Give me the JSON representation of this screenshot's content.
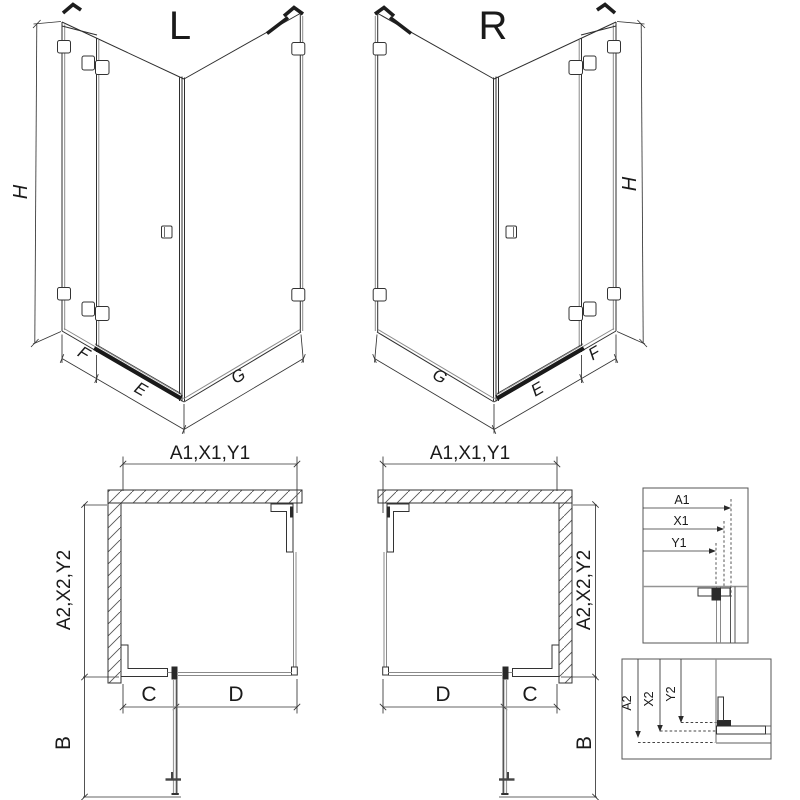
{
  "drawing": {
    "type": "shower-enclosure-technical-drawing",
    "background": "#ffffff",
    "line_color": "#2e2e2e",
    "glass_line_color": "#8a8a8a"
  },
  "variant_left": {
    "label": "L",
    "dim_height": "H",
    "dim_fixed": "F",
    "dim_door": "E",
    "dim_side": "G"
  },
  "variant_right": {
    "label": "R",
    "dim_height": "H",
    "dim_fixed": "F",
    "dim_door": "E",
    "dim_side": "G"
  },
  "plan_left": {
    "width_label": "A1,X1,Y1",
    "depth_label": "A2,X2,Y2",
    "dim_c": "C",
    "dim_d": "D",
    "dim_b": "B"
  },
  "plan_right": {
    "width_label": "A1,X1,Y1",
    "depth_label": "A2,X2,Y2",
    "dim_c": "C",
    "dim_d": "D",
    "dim_b": "B"
  },
  "detail_width": {
    "outer": "A1",
    "mid": "X1",
    "inner": "Y1"
  },
  "detail_depth": {
    "outer": "A2",
    "mid": "X2",
    "inner": "Y2"
  }
}
